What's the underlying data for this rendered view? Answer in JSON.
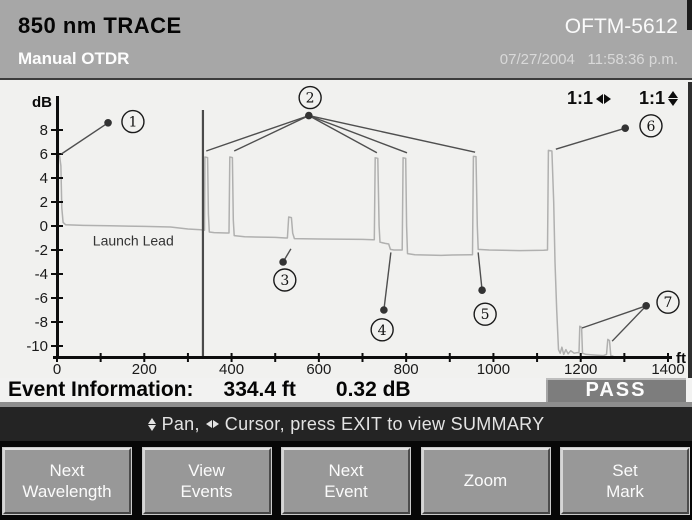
{
  "header": {
    "trace_title": "850 nm TRACE",
    "model": "OFTM-5612",
    "mode": "Manual OTDR",
    "datetime": "07/27/2004   11:58:36 p.m."
  },
  "chart_data": {
    "type": "line",
    "title": "850 nm OTDR trace",
    "xlabel": "ft",
    "ylabel": "dB",
    "xlim": [
      0,
      1400
    ],
    "ylim": [
      -10,
      8
    ],
    "grid": false,
    "x_major_ticks": [
      0,
      200,
      400,
      600,
      800,
      1000,
      1200,
      1400
    ],
    "x_minor_step": 100,
    "y_ticks": [
      8,
      6,
      4,
      2,
      0,
      -2,
      -4,
      -6,
      -8,
      -10
    ],
    "zoom_horizontal": "1:1",
    "zoom_vertical": "1:1",
    "annotation_label": "Launch Lead",
    "annotation_pos": [
      82,
      -1.62
    ],
    "cursor_ft": 334.4,
    "trace_color": "#b0b0af",
    "cursor_color": "#4a4a4a",
    "trace_ft_db": [
      [
        0,
        1.3
      ],
      [
        1,
        5.9
      ],
      [
        6,
        5.85
      ],
      [
        9,
        5.0
      ],
      [
        11,
        1.5
      ],
      [
        14,
        0.3
      ],
      [
        20,
        0.1
      ],
      [
        60,
        0.05
      ],
      [
        120,
        0.02
      ],
      [
        200,
        -0.03
      ],
      [
        260,
        -0.08
      ],
      [
        300,
        -0.25
      ],
      [
        330,
        -0.32
      ],
      [
        336,
        -0.35
      ],
      [
        338,
        -0.35
      ],
      [
        339,
        5.75
      ],
      [
        345,
        5.7
      ],
      [
        347,
        1.0
      ],
      [
        349,
        -0.5
      ],
      [
        360,
        -0.55
      ],
      [
        388,
        -0.58
      ],
      [
        394,
        -0.58
      ],
      [
        396,
        5.75
      ],
      [
        402,
        5.7
      ],
      [
        404,
        0.5
      ],
      [
        406,
        -0.8
      ],
      [
        430,
        -0.9
      ],
      [
        500,
        -0.95
      ],
      [
        524,
        -1.0
      ],
      [
        528,
        -1.0
      ],
      [
        531,
        0.75
      ],
      [
        537,
        0.7
      ],
      [
        540,
        -0.6
      ],
      [
        544,
        -1.05
      ],
      [
        600,
        -1.08
      ],
      [
        700,
        -1.12
      ],
      [
        724,
        -1.15
      ],
      [
        727,
        -1.15
      ],
      [
        729,
        5.68
      ],
      [
        735,
        5.64
      ],
      [
        738,
        0.0
      ],
      [
        740,
        -1.35
      ],
      [
        752,
        -1.45
      ],
      [
        760,
        -1.5
      ],
      [
        764,
        -1.95
      ],
      [
        772,
        -2.0
      ],
      [
        788,
        -2.0
      ],
      [
        791,
        -2.0
      ],
      [
        793,
        5.68
      ],
      [
        799,
        5.64
      ],
      [
        801,
        0.0
      ],
      [
        803,
        -2.3
      ],
      [
        820,
        -2.4
      ],
      [
        880,
        -2.45
      ],
      [
        905,
        -2.42
      ],
      [
        948,
        -2.4
      ],
      [
        952,
        -2.4
      ],
      [
        954,
        5.8
      ],
      [
        960,
        5.78
      ],
      [
        963,
        0.0
      ],
      [
        965,
        -1.95
      ],
      [
        990,
        -2.0
      ],
      [
        1060,
        -2.05
      ],
      [
        1115,
        -2.02
      ],
      [
        1124,
        -2.0
      ],
      [
        1126,
        6.3
      ],
      [
        1134,
        6.25
      ],
      [
        1138,
        2.0
      ],
      [
        1141,
        -3.0
      ],
      [
        1145,
        -7.0
      ],
      [
        1149,
        -10.3
      ],
      [
        1153,
        -10.6
      ],
      [
        1157,
        -10.1
      ],
      [
        1161,
        -10.7
      ],
      [
        1166,
        -10.3
      ],
      [
        1171,
        -10.65
      ],
      [
        1177,
        -10.4
      ],
      [
        1185,
        -10.6
      ],
      [
        1192,
        -10.55
      ],
      [
        1196,
        -10.55
      ],
      [
        1198,
        -8.35
      ],
      [
        1202,
        -8.45
      ],
      [
        1204,
        -10.6
      ],
      [
        1212,
        -10.7
      ],
      [
        1230,
        -10.75
      ],
      [
        1252,
        -10.8
      ],
      [
        1259,
        -10.7
      ],
      [
        1262,
        -9.45
      ],
      [
        1266,
        -9.55
      ],
      [
        1269,
        -10.8
      ],
      [
        1275,
        -10.85
      ]
    ],
    "events": [
      {
        "n": "1",
        "dot": [
          117,
          8.6
        ],
        "circle": [
          174,
          8.7
        ],
        "targets": [
          [
            10,
            6.0
          ]
        ]
      },
      {
        "n": "2",
        "dot": [
          577,
          9.2
        ],
        "circle": [
          580,
          10.7
        ],
        "targets": [
          [
            342,
            6.25
          ],
          [
            406,
            6.25
          ],
          [
            733,
            6.1
          ],
          [
            802,
            6.1
          ],
          [
            958,
            6.15
          ]
        ]
      },
      {
        "n": "3",
        "dot": [
          518,
          -3.0
        ],
        "circle": [
          522,
          -4.5
        ],
        "targets": [
          [
            536,
            -1.9
          ]
        ]
      },
      {
        "n": "4",
        "dot": [
          749,
          -7.0
        ],
        "circle": [
          745,
          -8.65
        ],
        "targets": [
          [
            765,
            -2.2
          ]
        ]
      },
      {
        "n": "5",
        "dot": [
          974,
          -5.35
        ],
        "circle": [
          981,
          -7.35
        ],
        "targets": [
          [
            965,
            -2.2
          ]
        ]
      },
      {
        "n": "6",
        "dot": [
          1302,
          8.15
        ],
        "circle": [
          1361,
          8.35
        ],
        "targets": [
          [
            1143,
            6.4
          ]
        ]
      },
      {
        "n": "7",
        "dot": [
          1350,
          -6.65
        ],
        "circle": [
          1400,
          -6.35
        ],
        "targets": [
          [
            1203,
            -8.5
          ],
          [
            1272,
            -9.6
          ]
        ]
      }
    ]
  },
  "event_info": {
    "label": "Event Information:",
    "distance": "334.4 ft",
    "loss": "0.32 dB",
    "result": "PASS"
  },
  "status_bar": {
    "pan_label": "Pan,",
    "cursor_label": "Cursor, press EXIT to view SUMMARY"
  },
  "softkeys": [
    {
      "line1": "Next",
      "line2": "Wavelength"
    },
    {
      "line1": "View",
      "line2": "Events"
    },
    {
      "line1": "Next",
      "line2": "Event"
    },
    {
      "line1": "Zoom",
      "line2": ""
    },
    {
      "line1": "Set",
      "line2": "Mark"
    }
  ],
  "colors": {
    "header_bg": "#a7a7a7",
    "chart_bg": "#f1f1ef",
    "trace": "#b0b0af",
    "status_bg": "#242424",
    "pass_badge_bg": "#7d7d7d",
    "softkey_bg": "#989898"
  }
}
